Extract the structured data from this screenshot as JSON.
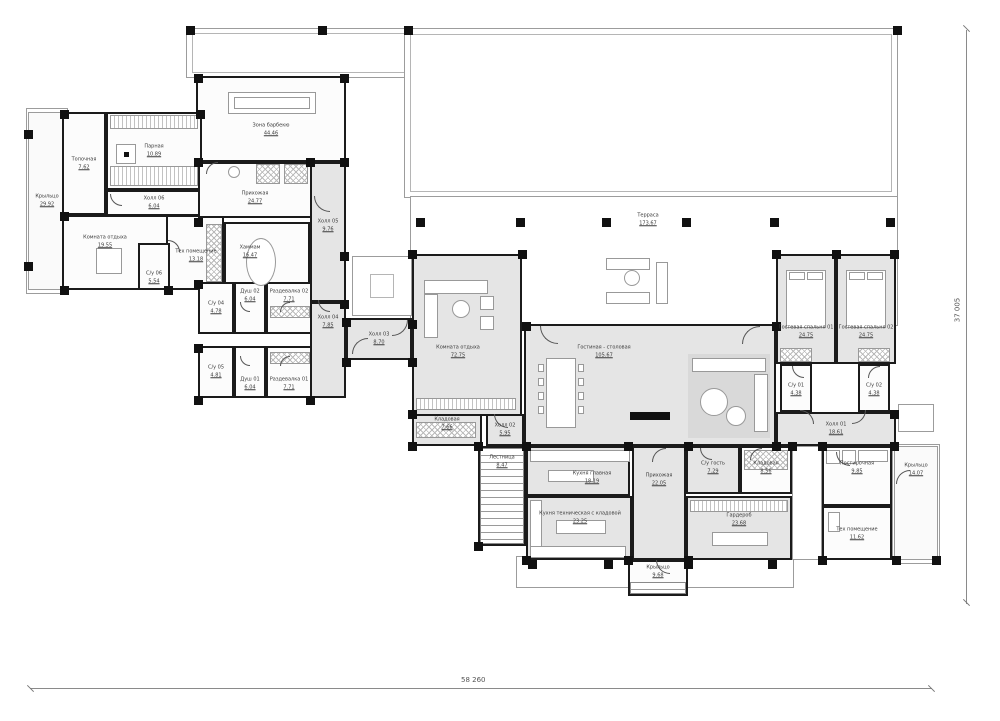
{
  "drawing": {
    "type": "architectural-floor-plan",
    "dimensions": {
      "bottom": "58 260",
      "right": "37 005"
    },
    "colors": {
      "wall": "#1b1b1b",
      "room_gray": "#e5e5e5",
      "room_white": "#fcfcfc",
      "deck_line": "#9c9c9c",
      "label": "#3b3b3b"
    }
  },
  "rooms": [
    {
      "name": "Крыльцо",
      "area": "29.92",
      "x": 28,
      "y": 112,
      "w": 38,
      "h": 178,
      "fill": "deckfill"
    },
    {
      "name": "Зона барбекю",
      "area": "44.46",
      "x": 196,
      "y": 76,
      "w": 150,
      "h": 86,
      "fill": "white",
      "ly": 130
    },
    {
      "name": "Топочная",
      "area": "7.62",
      "x": 62,
      "y": 112,
      "w": 44,
      "h": 103,
      "fill": "white"
    },
    {
      "name": "Парная",
      "area": "10.89",
      "x": 106,
      "y": 112,
      "w": 96,
      "h": 78,
      "fill": "white"
    },
    {
      "name": "Холл 06",
      "area": "6.04",
      "x": 106,
      "y": 190,
      "w": 96,
      "h": 26,
      "fill": "white"
    },
    {
      "name": "Комната отдыха",
      "area": "19.55",
      "x": 62,
      "y": 215,
      "w": 106,
      "h": 75,
      "fill": "white",
      "lx": 105,
      "ly": 242
    },
    {
      "name": "Тех помещение",
      "area": "13.18",
      "x": 166,
      "y": 215,
      "w": 58,
      "h": 75,
      "fill": "white",
      "lx": 196,
      "ly": 256
    },
    {
      "name": "С/у 06",
      "area": "5.54",
      "x": 138,
      "y": 243,
      "w": 32,
      "h": 47,
      "fill": "white",
      "ly": 278
    },
    {
      "name": "Прихожая",
      "area": "24.77",
      "x": 198,
      "y": 162,
      "w": 114,
      "h": 56,
      "fill": "white",
      "ly": 198
    },
    {
      "name": "Хаммам",
      "area": "16.47",
      "x": 224,
      "y": 222,
      "w": 86,
      "h": 68,
      "fill": "white",
      "lx": 250,
      "ly": 252
    },
    {
      "name": "Холл 05",
      "area": "9.76",
      "x": 310,
      "y": 162,
      "w": 36,
      "h": 140,
      "fill": "gray",
      "ly": 226
    },
    {
      "name": "С/у 04",
      "area": "4.78",
      "x": 198,
      "y": 282,
      "w": 36,
      "h": 52,
      "fill": "white"
    },
    {
      "name": "С/у 05",
      "area": "4.81",
      "x": 198,
      "y": 346,
      "w": 36,
      "h": 52,
      "fill": "white"
    },
    {
      "name": "Душ 02",
      "area": "6.04",
      "x": 234,
      "y": 282,
      "w": 32,
      "h": 52,
      "fill": "white",
      "ly": 296
    },
    {
      "name": "Душ 01",
      "area": "6.04",
      "x": 234,
      "y": 346,
      "w": 32,
      "h": 52,
      "fill": "white",
      "ly": 384
    },
    {
      "name": "Раздевалка 02",
      "area": "7.71",
      "x": 266,
      "y": 282,
      "w": 46,
      "h": 52,
      "fill": "white",
      "ly": 296
    },
    {
      "name": "Раздевалка 01",
      "area": "7.71",
      "x": 266,
      "y": 346,
      "w": 46,
      "h": 52,
      "fill": "white",
      "ly": 384
    },
    {
      "name": "Холл 04",
      "area": "7.85",
      "x": 310,
      "y": 302,
      "w": 36,
      "h": 96,
      "fill": "gray",
      "ly": 322
    },
    {
      "name": "Холл 03",
      "area": "8.70",
      "x": 346,
      "y": 318,
      "w": 66,
      "h": 42,
      "fill": "gray"
    },
    {
      "name": "Терраса",
      "area": "173.67",
      "x": 600,
      "y": 202,
      "w": 96,
      "h": 36,
      "fill": "none"
    },
    {
      "name": "Комната отдыха",
      "area": "72.75",
      "x": 412,
      "y": 254,
      "w": 110,
      "h": 162,
      "fill": "gray",
      "lx": 458,
      "ly": 352
    },
    {
      "name": "Кладовая",
      "area": "7.66",
      "x": 412,
      "y": 414,
      "w": 70,
      "h": 32,
      "fill": "gray",
      "ly": 424
    },
    {
      "name": "Холл 02",
      "area": "5.95",
      "x": 486,
      "y": 414,
      "w": 38,
      "h": 32,
      "fill": "gray"
    },
    {
      "name": "Гостиная - столовая",
      "area": "105.67",
      "x": 524,
      "y": 324,
      "w": 252,
      "h": 122,
      "fill": "gray",
      "lx": 604,
      "ly": 352
    },
    {
      "name": "Гостевая спальня 01",
      "area": "24.75",
      "x": 776,
      "y": 254,
      "w": 60,
      "h": 110,
      "fill": "gray",
      "ly": 332
    },
    {
      "name": "Гостевая спальня 02",
      "area": "24.75",
      "x": 836,
      "y": 254,
      "w": 60,
      "h": 110,
      "fill": "gray",
      "ly": 332
    },
    {
      "name": "С/у 01",
      "area": "4.38",
      "x": 780,
      "y": 364,
      "w": 32,
      "h": 48,
      "fill": "white",
      "ly": 390
    },
    {
      "name": "С/у 02",
      "area": "4.38",
      "x": 858,
      "y": 364,
      "w": 32,
      "h": 48,
      "fill": "white",
      "ly": 390
    },
    {
      "name": "Холл 01",
      "area": "18.61",
      "x": 776,
      "y": 412,
      "w": 120,
      "h": 34,
      "fill": "gray"
    },
    {
      "name": "Лестница",
      "area": "8.47",
      "x": 478,
      "y": 446,
      "w": 48,
      "h": 100,
      "fill": "white",
      "ly": 462
    },
    {
      "name": "Кухня главная",
      "area": "18.19",
      "x": 526,
      "y": 446,
      "w": 104,
      "h": 50,
      "fill": "gray",
      "lx": 592,
      "ly": 478
    },
    {
      "name": "Кухня техническая с кладовой",
      "area": "23.25",
      "x": 526,
      "y": 496,
      "w": 106,
      "h": 64,
      "fill": "gray",
      "lx": 580,
      "ly": 518
    },
    {
      "name": "Прихожая",
      "area": "22.05",
      "x": 632,
      "y": 446,
      "w": 54,
      "h": 114,
      "fill": "gray",
      "ly": 480
    },
    {
      "name": "С/у гость",
      "area": "7.29",
      "x": 686,
      "y": 446,
      "w": 54,
      "h": 48,
      "fill": "gray",
      "ly": 468
    },
    {
      "name": "Кладовая",
      "area": "8.56",
      "x": 740,
      "y": 446,
      "w": 52,
      "h": 48,
      "fill": "white",
      "ly": 468
    },
    {
      "name": "Гардероб",
      "area": "23.68",
      "x": 686,
      "y": 496,
      "w": 106,
      "h": 64,
      "fill": "gray",
      "ly": 520
    },
    {
      "name": "Постирочная",
      "area": "9.85",
      "x": 822,
      "y": 446,
      "w": 70,
      "h": 60,
      "fill": "white",
      "ly": 468
    },
    {
      "name": "Тех помещение",
      "area": "11.62",
      "x": 822,
      "y": 506,
      "w": 70,
      "h": 54,
      "fill": "white",
      "ly": 534
    },
    {
      "name": "Крыльцо",
      "area": "14.07",
      "x": 894,
      "y": 446,
      "w": 44,
      "h": 114,
      "fill": "deckfill",
      "ly": 470
    },
    {
      "name": "Крыльцо",
      "area": "9.68",
      "x": 628,
      "y": 560,
      "w": 60,
      "h": 36,
      "fill": "white",
      "ly": 572
    }
  ],
  "decks": [
    {
      "x": 186,
      "y": 28,
      "w": 236,
      "h": 50
    },
    {
      "x": 192,
      "y": 33,
      "w": 224,
      "h": 40,
      "inner": true
    },
    {
      "x": 404,
      "y": 28,
      "w": 494,
      "h": 170
    },
    {
      "x": 410,
      "y": 34,
      "w": 482,
      "h": 158,
      "inner": true
    },
    {
      "x": 410,
      "y": 196,
      "w": 488,
      "h": 130
    },
    {
      "x": 26,
      "y": 108,
      "w": 42,
      "h": 186
    },
    {
      "x": 892,
      "y": 444,
      "w": 48,
      "h": 120
    },
    {
      "x": 516,
      "y": 556,
      "w": 278,
      "h": 32
    },
    {
      "x": 792,
      "y": 446,
      "w": 30,
      "h": 114
    },
    {
      "x": 352,
      "y": 256,
      "w": 60,
      "h": 60
    },
    {
      "x": 370,
      "y": 274,
      "w": 24,
      "h": 24,
      "inner": true
    },
    {
      "x": 898,
      "y": 404,
      "w": 36,
      "h": 28
    }
  ],
  "columns": [
    [
      416,
      218
    ],
    [
      516,
      218
    ],
    [
      602,
      218
    ],
    [
      682,
      218
    ],
    [
      770,
      218
    ],
    [
      886,
      218
    ],
    [
      404,
      26
    ],
    [
      318,
      26
    ],
    [
      893,
      26
    ],
    [
      186,
      26
    ],
    [
      24,
      130
    ],
    [
      24,
      262
    ],
    [
      528,
      560
    ],
    [
      604,
      560
    ],
    [
      684,
      560
    ],
    [
      768,
      560
    ],
    [
      892,
      556
    ],
    [
      932,
      556
    ],
    [
      194,
      74
    ],
    [
      340,
      74
    ],
    [
      194,
      158
    ],
    [
      306,
      158
    ],
    [
      340,
      158
    ],
    [
      60,
      110
    ],
    [
      196,
      110
    ],
    [
      60,
      212
    ],
    [
      60,
      286
    ],
    [
      164,
      286
    ],
    [
      194,
      218
    ],
    [
      194,
      280
    ],
    [
      194,
      344
    ],
    [
      194,
      396
    ],
    [
      306,
      396
    ],
    [
      340,
      300
    ],
    [
      340,
      252
    ],
    [
      408,
      250
    ],
    [
      518,
      250
    ],
    [
      522,
      322
    ],
    [
      772,
      322
    ],
    [
      772,
      250
    ],
    [
      832,
      250
    ],
    [
      890,
      250
    ],
    [
      890,
      410
    ],
    [
      772,
      442
    ],
    [
      890,
      442
    ],
    [
      624,
      442
    ],
    [
      684,
      442
    ],
    [
      788,
      442
    ],
    [
      818,
      442
    ],
    [
      818,
      556
    ],
    [
      684,
      556
    ],
    [
      624,
      556
    ],
    [
      522,
      442
    ],
    [
      474,
      442
    ],
    [
      474,
      542
    ],
    [
      522,
      556
    ],
    [
      408,
      410
    ],
    [
      408,
      442
    ],
    [
      408,
      320
    ],
    [
      342,
      318
    ],
    [
      342,
      358
    ],
    [
      408,
      358
    ]
  ],
  "furniture": [
    {
      "t": "rect",
      "x": 228,
      "y": 92,
      "w": 88,
      "h": 22
    },
    {
      "t": "rect",
      "x": 234,
      "y": 97,
      "w": 76,
      "h": 12
    },
    {
      "t": "linesv",
      "x": 110,
      "y": 115,
      "w": 88,
      "h": 14
    },
    {
      "t": "linesv",
      "x": 110,
      "y": 166,
      "w": 88,
      "h": 20
    },
    {
      "t": "rect",
      "x": 116,
      "y": 144,
      "w": 20,
      "h": 20
    },
    {
      "t": "black",
      "x": 124,
      "y": 152,
      "w": 5,
      "h": 5
    },
    {
      "t": "circle",
      "x": 246,
      "y": 238,
      "w": 30,
      "h": 48
    },
    {
      "t": "hatchx",
      "x": 206,
      "y": 224,
      "w": 16,
      "h": 58
    },
    {
      "t": "hatchx",
      "x": 270,
      "y": 306,
      "w": 40,
      "h": 12
    },
    {
      "t": "hatchx",
      "x": 270,
      "y": 352,
      "w": 40,
      "h": 12
    },
    {
      "t": "hatchx",
      "x": 256,
      "y": 164,
      "w": 24,
      "h": 20
    },
    {
      "t": "hatchx",
      "x": 284,
      "y": 164,
      "w": 24,
      "h": 20
    },
    {
      "t": "circle",
      "x": 228,
      "y": 166,
      "w": 12,
      "h": 12
    },
    {
      "t": "rect",
      "x": 96,
      "y": 248,
      "w": 26,
      "h": 26
    },
    {
      "t": "rect",
      "x": 546,
      "y": 358,
      "w": 30,
      "h": 70
    },
    {
      "t": "rect",
      "x": 538,
      "y": 364,
      "w": 6,
      "h": 8
    },
    {
      "t": "rect",
      "x": 538,
      "y": 378,
      "w": 6,
      "h": 8
    },
    {
      "t": "rect",
      "x": 538,
      "y": 392,
      "w": 6,
      "h": 8
    },
    {
      "t": "rect",
      "x": 538,
      "y": 406,
      "w": 6,
      "h": 8
    },
    {
      "t": "rect",
      "x": 578,
      "y": 364,
      "w": 6,
      "h": 8
    },
    {
      "t": "rect",
      "x": 578,
      "y": 378,
      "w": 6,
      "h": 8
    },
    {
      "t": "rect",
      "x": 578,
      "y": 392,
      "w": 6,
      "h": 8
    },
    {
      "t": "rect",
      "x": 578,
      "y": 406,
      "w": 6,
      "h": 8
    },
    {
      "t": "fill",
      "x": 688,
      "y": 354,
      "w": 82,
      "h": 84
    },
    {
      "t": "rect",
      "x": 692,
      "y": 358,
      "w": 74,
      "h": 14
    },
    {
      "t": "rect",
      "x": 754,
      "y": 374,
      "w": 14,
      "h": 58
    },
    {
      "t": "circle",
      "x": 700,
      "y": 388,
      "w": 28,
      "h": 28
    },
    {
      "t": "circle",
      "x": 726,
      "y": 406,
      "w": 20,
      "h": 20
    },
    {
      "t": "black",
      "x": 630,
      "y": 412,
      "w": 40,
      "h": 8
    },
    {
      "t": "rect",
      "x": 424,
      "y": 280,
      "w": 64,
      "h": 14
    },
    {
      "t": "rect",
      "x": 424,
      "y": 294,
      "w": 14,
      "h": 44
    },
    {
      "t": "circle",
      "x": 452,
      "y": 300,
      "w": 18,
      "h": 18
    },
    {
      "t": "rect",
      "x": 480,
      "y": 296,
      "w": 14,
      "h": 14
    },
    {
      "t": "rect",
      "x": 480,
      "y": 316,
      "w": 14,
      "h": 14
    },
    {
      "t": "linesv",
      "x": 416,
      "y": 398,
      "w": 100,
      "h": 12
    },
    {
      "t": "rect",
      "x": 606,
      "y": 258,
      "w": 44,
      "h": 12
    },
    {
      "t": "rect",
      "x": 606,
      "y": 292,
      "w": 44,
      "h": 12
    },
    {
      "t": "rect",
      "x": 656,
      "y": 262,
      "w": 12,
      "h": 42
    },
    {
      "t": "circle",
      "x": 624,
      "y": 270,
      "w": 16,
      "h": 16
    },
    {
      "t": "rect",
      "x": 786,
      "y": 270,
      "w": 40,
      "h": 58
    },
    {
      "t": "rect",
      "x": 789,
      "y": 272,
      "w": 16,
      "h": 8
    },
    {
      "t": "rect",
      "x": 807,
      "y": 272,
      "w": 16,
      "h": 8
    },
    {
      "t": "rect",
      "x": 846,
      "y": 270,
      "w": 40,
      "h": 58
    },
    {
      "t": "rect",
      "x": 849,
      "y": 272,
      "w": 16,
      "h": 8
    },
    {
      "t": "rect",
      "x": 867,
      "y": 272,
      "w": 16,
      "h": 8
    },
    {
      "t": "hatchx",
      "x": 780,
      "y": 348,
      "w": 32,
      "h": 14
    },
    {
      "t": "hatchx",
      "x": 858,
      "y": 348,
      "w": 32,
      "h": 14
    },
    {
      "t": "rect",
      "x": 530,
      "y": 450,
      "w": 100,
      "h": 12
    },
    {
      "t": "rect",
      "x": 548,
      "y": 470,
      "w": 46,
      "h": 12
    },
    {
      "t": "rect",
      "x": 530,
      "y": 500,
      "w": 12,
      "h": 56
    },
    {
      "t": "rect",
      "x": 530,
      "y": 546,
      "w": 96,
      "h": 12
    },
    {
      "t": "rect",
      "x": 556,
      "y": 520,
      "w": 50,
      "h": 14
    },
    {
      "t": "linesv",
      "x": 690,
      "y": 500,
      "w": 98,
      "h": 12
    },
    {
      "t": "rect",
      "x": 712,
      "y": 532,
      "w": 56,
      "h": 14
    },
    {
      "t": "hatchx",
      "x": 744,
      "y": 450,
      "w": 44,
      "h": 20
    },
    {
      "t": "hatchx",
      "x": 416,
      "y": 422,
      "w": 60,
      "h": 16
    },
    {
      "t": "rect",
      "x": 826,
      "y": 450,
      "w": 14,
      "h": 14
    },
    {
      "t": "rect",
      "x": 842,
      "y": 450,
      "w": 14,
      "h": 14
    },
    {
      "t": "rect",
      "x": 858,
      "y": 450,
      "w": 30,
      "h": 12
    },
    {
      "t": "rect",
      "x": 828,
      "y": 512,
      "w": 12,
      "h": 20
    },
    {
      "t": "stairs",
      "x": 480,
      "y": 448,
      "w": 44,
      "h": 96
    },
    {
      "t": "stairs",
      "x": 630,
      "y": 582,
      "w": 56,
      "h": 12
    }
  ],
  "doors": [
    {
      "x": 314,
      "y": 196,
      "r": 16,
      "rot": 0
    },
    {
      "x": 352,
      "y": 338,
      "r": 16,
      "rot": 90
    },
    {
      "x": 392,
      "y": 320,
      "r": 16,
      "rot": 270
    },
    {
      "x": 494,
      "y": 414,
      "r": 14,
      "rot": 0
    },
    {
      "x": 540,
      "y": 326,
      "r": 18,
      "rot": 0
    },
    {
      "x": 742,
      "y": 326,
      "r": 18,
      "rot": 90
    },
    {
      "x": 800,
      "y": 410,
      "r": 14,
      "rot": 180
    },
    {
      "x": 852,
      "y": 410,
      "r": 14,
      "rot": 270
    },
    {
      "x": 792,
      "y": 366,
      "r": 12,
      "rot": 0
    },
    {
      "x": 868,
      "y": 366,
      "r": 12,
      "rot": 90
    },
    {
      "x": 652,
      "y": 448,
      "r": 14,
      "rot": 90
    },
    {
      "x": 700,
      "y": 448,
      "r": 12,
      "rot": 0
    },
    {
      "x": 750,
      "y": 448,
      "r": 12,
      "rot": 90
    },
    {
      "x": 836,
      "y": 452,
      "r": 14,
      "rot": 0
    },
    {
      "x": 896,
      "y": 470,
      "r": 14,
      "rot": 90
    },
    {
      "x": 168,
      "y": 240,
      "r": 12,
      "rot": 180
    },
    {
      "x": 110,
      "y": 194,
      "r": 12,
      "rot": 0
    },
    {
      "x": 206,
      "y": 162,
      "r": 12,
      "rot": 90
    },
    {
      "x": 240,
      "y": 302,
      "r": 10,
      "rot": 0
    },
    {
      "x": 240,
      "y": 356,
      "r": 10,
      "rot": 0
    },
    {
      "x": 280,
      "y": 302,
      "r": 10,
      "rot": 90
    },
    {
      "x": 280,
      "y": 356,
      "r": 10,
      "rot": 90
    },
    {
      "x": 318,
      "y": 300,
      "r": 12,
      "rot": 0
    },
    {
      "x": 656,
      "y": 560,
      "r": 14,
      "rot": 0
    }
  ]
}
